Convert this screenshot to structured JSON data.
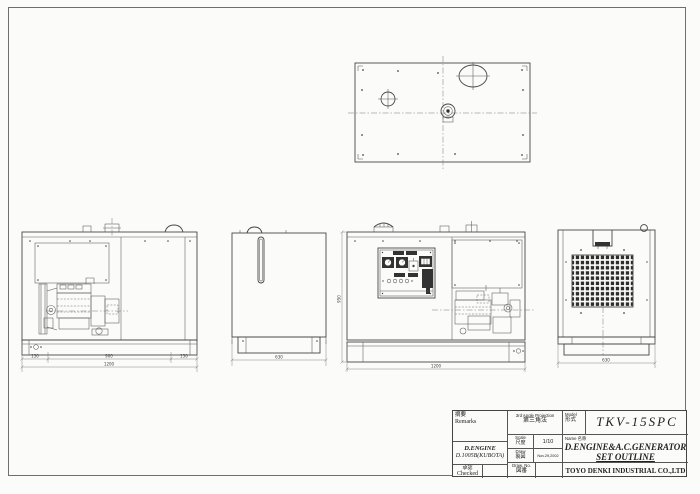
{
  "sheet": {
    "background": "#fbfbf9",
    "line_color": "#474747"
  },
  "dimensions": {
    "side_left": "150",
    "side_mid": "900",
    "side_right": "150",
    "side_total": "1200",
    "front_total": "1200",
    "front_height": "950",
    "radiator_end_width": "630",
    "grille_end_width": "630"
  },
  "title_block": {
    "remarks_kanji": "摘要",
    "remarks_label": "Remarks",
    "engine_line1": "D.ENGINE",
    "engine_line2": "D.1005B(KUBOTA)",
    "approved_kanji": "承認",
    "approved_label": "Checked",
    "projection_label": "3rd Angle Projection",
    "projection_kanji": "第三角法",
    "scale_label": "Scale",
    "scale_kanji": "尺度",
    "scale_value": "1/10",
    "draw_label": "Draw",
    "draw_kanji": "製図",
    "draw_value": "Nov.29,2002",
    "drawno_label": "Draw. No.",
    "drawno_kanji": "図番",
    "model_label": "Model",
    "model_kanji": "形式",
    "model_value": "TKV-15SPC",
    "name_label": "Name",
    "name_kanji": "名称",
    "name_line1": "D.ENGINE&A.C.GENERATOR",
    "name_line2": "SET OUTLINE",
    "company": "TOYO DENKI INDUSTRIAL CO.,LTD"
  }
}
